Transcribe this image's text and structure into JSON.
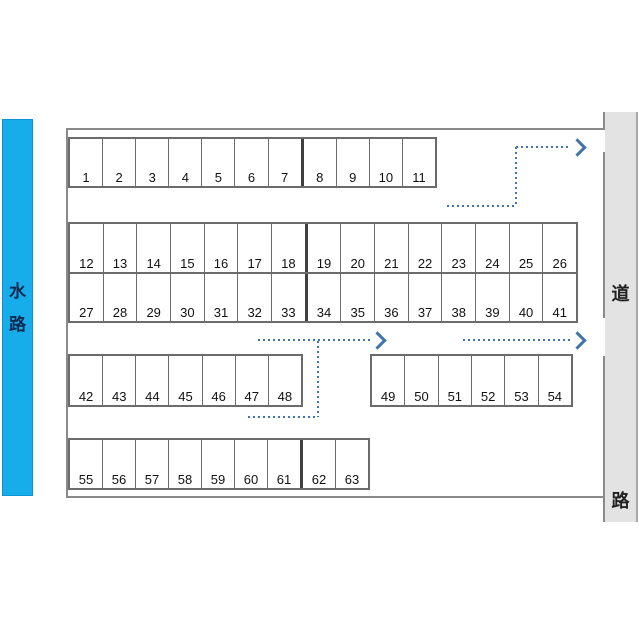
{
  "map": {
    "kind": "parking-lot-layout",
    "total_spaces": 63
  },
  "waterway": {
    "chars": [
      "水",
      "路"
    ],
    "label": "水路",
    "color": "#17ACEA"
  },
  "road": {
    "chars": [
      "道",
      "路"
    ],
    "label": "道路",
    "color": "#E3E3E3"
  },
  "rows": {
    "rowA": {
      "numbers": [
        "1",
        "2",
        "3",
        "4",
        "5",
        "6",
        "7",
        "8",
        "9",
        "10",
        "11"
      ],
      "seam_before": 7
    },
    "rowB": {
      "numbers": [
        "12",
        "13",
        "14",
        "15",
        "16",
        "17",
        "18",
        "19",
        "20",
        "21",
        "22",
        "23",
        "24",
        "25",
        "26"
      ],
      "seam_before": 7
    },
    "rowC": {
      "numbers": [
        "27",
        "28",
        "29",
        "30",
        "31",
        "32",
        "33",
        "34",
        "35",
        "36",
        "37",
        "38",
        "39",
        "40",
        "41"
      ],
      "seam_before": 7
    },
    "rowD": {
      "numbers": [
        "42",
        "43",
        "44",
        "45",
        "46",
        "47",
        "48"
      ],
      "seam_before": null
    },
    "rowF": {
      "numbers": [
        "49",
        "50",
        "51",
        "52",
        "53",
        "54"
      ],
      "seam_before": null
    },
    "rowE": {
      "numbers": [
        "55",
        "56",
        "57",
        "58",
        "59",
        "60",
        "61",
        "62",
        "63"
      ],
      "seam_before": 7
    }
  },
  "routes": {
    "arrow_color": "#3F74B3",
    "style": "dotted",
    "count": 3,
    "description_direction": "right"
  }
}
